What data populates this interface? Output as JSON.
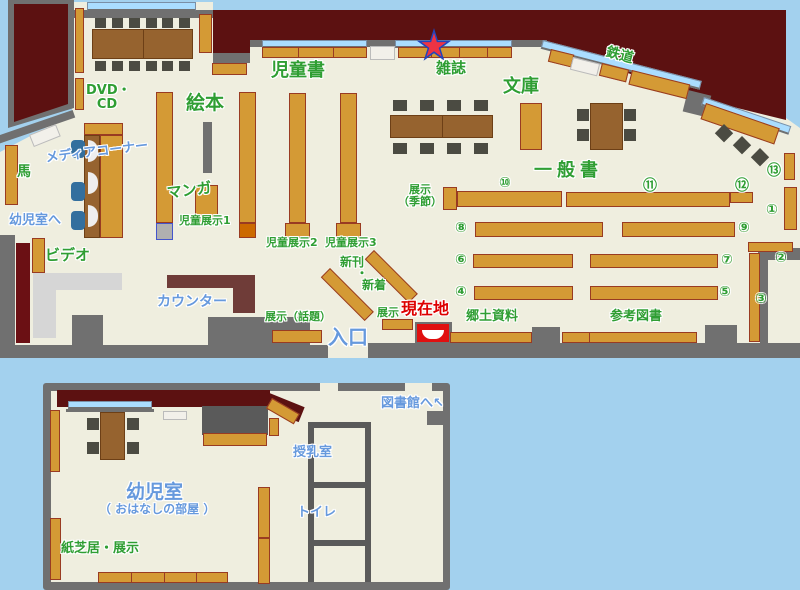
{
  "colors": {
    "page_bg": "#a3d1ee",
    "floor": "#efeedf",
    "outside": "#5c1111",
    "wall": "#707070",
    "shelf": "#d49a35",
    "shelf_border": "#993b22",
    "window": "#aaddff",
    "counter": "#6f3c38",
    "marker_red": "#e01010",
    "star_red": "#ee3344",
    "star_blue": "#2244bb",
    "text_green": "#2f9e33",
    "text_blue": "#6699dd",
    "text_red": "#dd0000"
  },
  "main_map": {
    "labels": {
      "dvd_cd_line1": "DVD・",
      "dvd_cd_line2": "CD",
      "jidosho": "児童書",
      "ehon": "絵本",
      "zasshi": "雑誌",
      "bunko": "文庫",
      "tetsudo": "鉄道",
      "ippansho": "一般書",
      "tenji_kisetsu_line1": "展示",
      "tenji_kisetsu_line2": "（季節）",
      "uma": "馬",
      "media_corner": "メディアコーナー",
      "manga": "マンガ",
      "yojishitsu_he": "幼児室へ",
      "video": "ビデオ",
      "counter": "カウンター",
      "jido_tenji1": "児童展示1",
      "jido_tenji2": "児童展示2",
      "jido_tenji3": "児童展示3",
      "shinkan": "新刊",
      "nakaguro": "・",
      "shinchaku": "新着",
      "tenji_wadai": "展示（話題）",
      "tenji": "展示",
      "iriguchi": "入口",
      "genzaichi": "現在地",
      "kyodo_shiryo": "郷土資料",
      "sanko_tosho": "参考図書"
    },
    "numbers": [
      "①",
      "②",
      "③",
      "④",
      "⑤",
      "⑥",
      "⑦",
      "⑧",
      "⑨",
      "⑩",
      "⑪",
      "⑫",
      "⑬"
    ]
  },
  "annex_map": {
    "labels": {
      "yojishitsu": "幼児室",
      "ohanashi": "（ おはなしの部屋 ）",
      "kamishibai": "紙芝居・展示",
      "junyushitsu": "授乳室",
      "toilet": "トイレ",
      "toshokan_he": "図書館へ",
      "arrow": "↖"
    }
  }
}
